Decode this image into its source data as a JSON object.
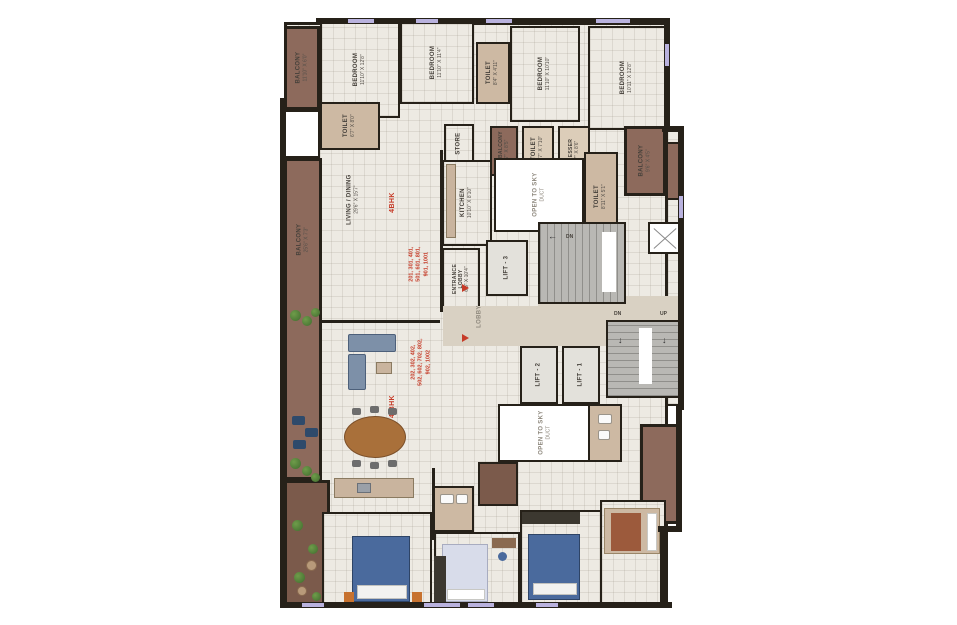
{
  "colors": {
    "wall": "#262119",
    "floor": "#edeae3",
    "balcony": "#8d6a5c",
    "toilet_tan": "#cdb9a3",
    "lobby": "#d9d1c3",
    "stairs": "#b9b8b4",
    "accent_red": "#c63b28",
    "window": "#b9b2de"
  },
  "rooms": {
    "balcony_tl": {
      "name": "BALCONY",
      "dims": "11'10\" X 6'0\""
    },
    "bedroom1": {
      "name": "BEDROOM",
      "dims": "11'10\" X 12'8\""
    },
    "bedroom2": {
      "name": "BEDROOM",
      "dims": "11'10\" X 11'4\""
    },
    "toilet_top": {
      "name": "TOILET",
      "dims": "8'4\" X 4'11\""
    },
    "bedroom3": {
      "name": "BEDROOM",
      "dims": "11'10\" X 10'10\""
    },
    "bedroom4": {
      "name": "BEDROOM",
      "dims": "10'11\" X 12'8\""
    },
    "toilet_left": {
      "name": "TOILET",
      "dims": "6'7\" X 8'0\""
    },
    "balcony_left": {
      "name": "BALCONY",
      "dims": "25'6\" X 7'3\""
    },
    "living": {
      "name": "LIVING / DINING",
      "dims": "29'6\" X 15'7\""
    },
    "store": {
      "name": "STORE"
    },
    "dry_balcony": {
      "name": "DRY BALCONY",
      "dims": "4'7\" X 8'5\""
    },
    "toilet_mid": {
      "name": "TOILET",
      "dims": "4'7\" X 7'10\""
    },
    "dresser": {
      "name": "DRESSER",
      "dims": "4'7\" X 8'6\""
    },
    "balcony_right": {
      "name": "BALCONY",
      "dims": "9'6\" X 4'5\""
    },
    "kitchen": {
      "name": "KITCHEN",
      "dims": "10'10\" X 8'10\""
    },
    "toilet_right": {
      "name": "TOILET",
      "dims": "8'11\" X 5'1\""
    },
    "duct": {
      "l1": "OPEN TO SKY",
      "l2": "DUCT"
    },
    "entrance_lobby": {
      "l1": "ENTRANCE",
      "l2": "LOBBY",
      "dims": "6'3\" X 10'4\""
    },
    "lift1": "LIFT - 1",
    "lift2": "LIFT - 2",
    "lift3": "LIFT - 3"
  },
  "labels": {
    "lobby": "LOBBY",
    "dn": "DN",
    "up": "UP"
  },
  "icons": {
    "arrow_left": "←",
    "arrow_down": "↓"
  },
  "units": {
    "top": {
      "bhk": "4BHK",
      "l1": "201, 301, 401,",
      "l2": "501, 601, 801,",
      "l3": "901, 1001"
    },
    "bottom": {
      "bhk": "4 BHK",
      "l1": "202, 302, 402,",
      "l2": "502, 602, 702, 802,",
      "l3": "902, 1002"
    }
  }
}
